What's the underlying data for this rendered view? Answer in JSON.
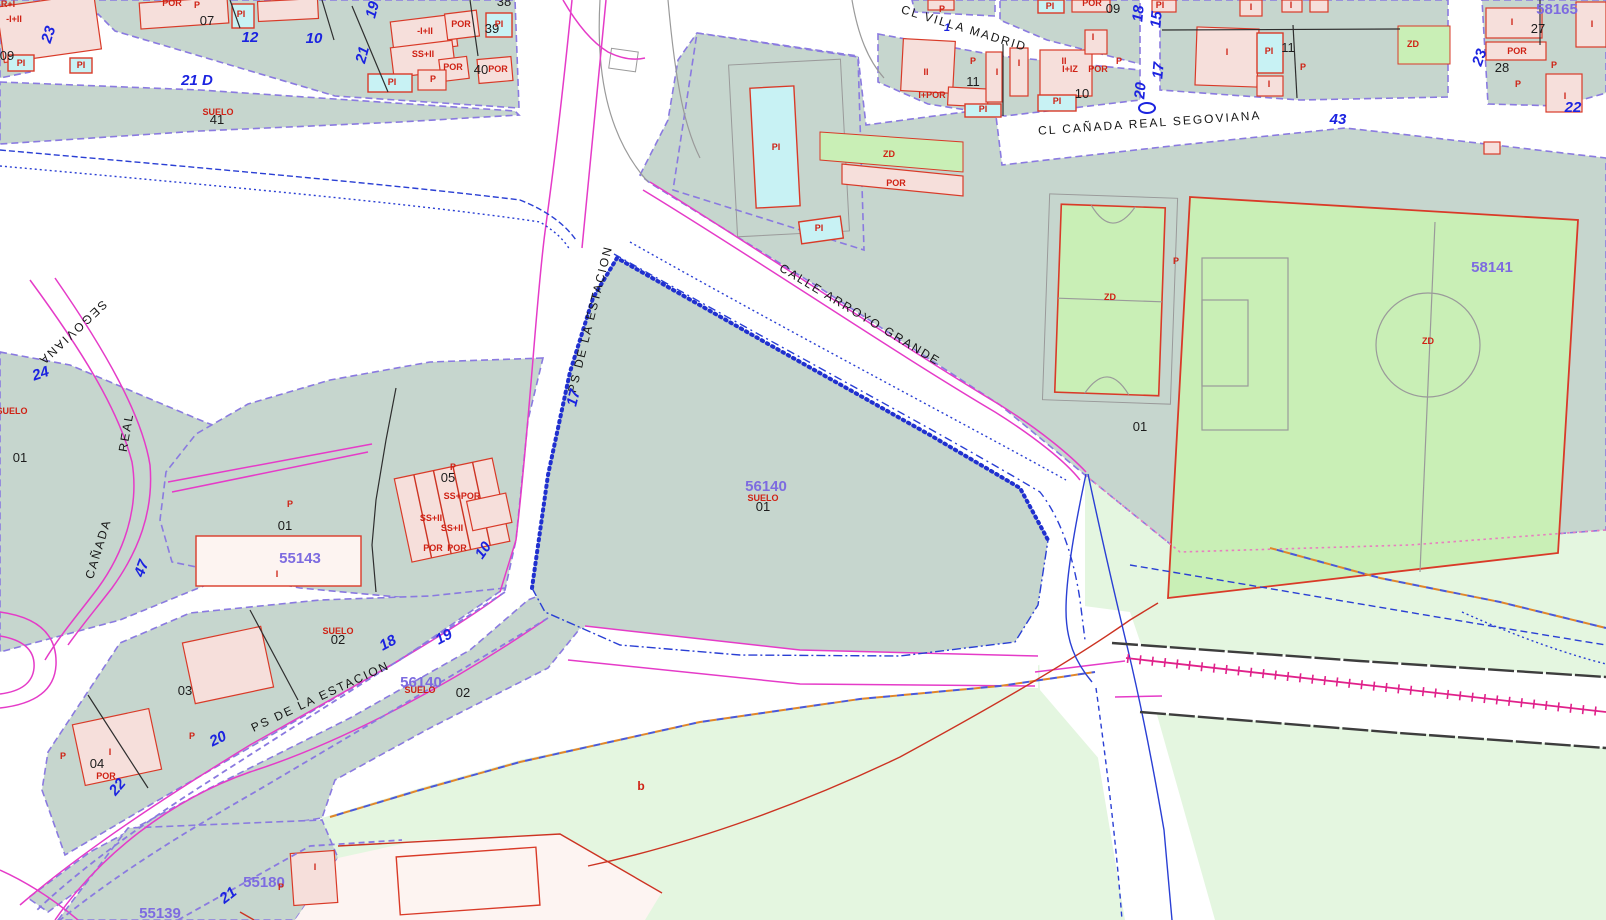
{
  "map": {
    "palette": {
      "urban_parcel": "#c6d6ce",
      "rustic_parcel": "#e4f6e0",
      "sports_green": "#c9efb6",
      "building": "#f6dfdb",
      "building_border": "#d93a28",
      "pool": "#c8f2f4",
      "parcel_border": "#8a7ae0",
      "street_line": "#e53bc8",
      "railway": "#e0218a",
      "stream": "#2a3fd4",
      "blue_number": "#1b23e0",
      "parcel_id": "#7d6be0",
      "use_label": "#cf2114"
    },
    "labels": [
      {
        "name": "street-cl-villa-madrid",
        "text": "CL VILLA MADRID",
        "x": 963,
        "y": 32,
        "rot": 17,
        "cls": "street"
      },
      {
        "name": "street-cl-canada-real-segoviana",
        "text": "CL  CAÑADA  REAL  SEGOVIANA",
        "x": 1150,
        "y": 127,
        "rot": -4,
        "cls": "street"
      },
      {
        "name": "street-calle-arroyo-grande",
        "text": "CALLE  ARROYO  GRANDE",
        "x": 858,
        "y": 318,
        "rot": 31,
        "cls": "street"
      },
      {
        "name": "street-ps-de-la-estacion-north",
        "text": "PS DE LA ESTACION",
        "x": 594,
        "y": 320,
        "rot": -76,
        "cls": "street"
      },
      {
        "name": "street-ps-de-la-estacion-south",
        "text": "PS  DE  LA  ESTACION",
        "x": 322,
        "y": 700,
        "rot": -25,
        "cls": "street"
      },
      {
        "name": "street-canada",
        "text": "CAÑADA",
        "x": 102,
        "y": 550,
        "rot": -73,
        "cls": "street"
      },
      {
        "name": "street-real",
        "text": "REAL",
        "x": 130,
        "y": 433,
        "rot": -80,
        "cls": "street"
      },
      {
        "name": "street-segoviana",
        "text": "SEGOVIANA",
        "x": 70,
        "y": 330,
        "rot": 137,
        "cls": "street"
      },
      {
        "name": "street-number",
        "text": "21 D",
        "x": 197,
        "y": 85,
        "rot": 0,
        "cls": "blue"
      },
      {
        "name": "street-number",
        "text": "12",
        "x": 250,
        "y": 42,
        "rot": 0,
        "cls": "blue"
      },
      {
        "name": "street-number",
        "text": "10",
        "x": 314,
        "y": 43,
        "rot": 0,
        "cls": "blue"
      },
      {
        "name": "street-number",
        "text": "23",
        "x": 53,
        "y": 36,
        "rot": -72,
        "cls": "blue"
      },
      {
        "name": "street-number",
        "text": "19",
        "x": 377,
        "y": 11,
        "rot": -75,
        "cls": "blue"
      },
      {
        "name": "street-number",
        "text": "21",
        "x": 367,
        "y": 56,
        "rot": -75,
        "cls": "blue"
      },
      {
        "name": "street-number",
        "text": "24",
        "x": 42,
        "y": 378,
        "rot": -18,
        "cls": "blue"
      },
      {
        "name": "street-number",
        "text": "47",
        "x": 146,
        "y": 570,
        "rot": -70,
        "cls": "blue"
      },
      {
        "name": "street-number",
        "text": "17",
        "x": 578,
        "y": 399,
        "rot": -76,
        "cls": "blue"
      },
      {
        "name": "street-number",
        "text": "10",
        "x": 487,
        "y": 553,
        "rot": -55,
        "cls": "blue"
      },
      {
        "name": "street-number",
        "text": "18",
        "x": 390,
        "y": 647,
        "rot": -28,
        "cls": "blue"
      },
      {
        "name": "street-number",
        "text": "19",
        "x": 446,
        "y": 641,
        "rot": -28,
        "cls": "blue"
      },
      {
        "name": "street-number",
        "text": "20",
        "x": 220,
        "y": 743,
        "rot": -26,
        "cls": "blue"
      },
      {
        "name": "street-number",
        "text": "22",
        "x": 121,
        "y": 790,
        "rot": -50,
        "cls": "blue"
      },
      {
        "name": "street-number",
        "text": "21",
        "x": 231,
        "y": 899,
        "rot": -38,
        "cls": "blue"
      },
      {
        "name": "street-number",
        "text": "1",
        "x": 947,
        "y": 31,
        "rot": 0,
        "cls": "blue sm"
      },
      {
        "name": "street-number",
        "text": "18",
        "x": 1143,
        "y": 14,
        "rot": -85,
        "cls": "blue"
      },
      {
        "name": "street-number",
        "text": "20",
        "x": 1145,
        "y": 91,
        "rot": -85,
        "cls": "blue"
      },
      {
        "name": "street-number",
        "text": "15",
        "x": 1161,
        "y": 20,
        "rot": -85,
        "cls": "blue"
      },
      {
        "name": "street-number",
        "text": "17",
        "x": 1163,
        "y": 71,
        "rot": -85,
        "cls": "blue"
      },
      {
        "name": "street-number",
        "text": "43",
        "x": 1338,
        "y": 124,
        "rot": 0,
        "cls": "blue"
      },
      {
        "name": "street-number",
        "text": "22",
        "x": 1573,
        "y": 112,
        "rot": 0,
        "cls": "blue"
      },
      {
        "name": "street-number",
        "text": "23",
        "x": 1484,
        "y": 59,
        "rot": -70,
        "cls": "blue"
      },
      {
        "name": "parcel-id",
        "text": "58165",
        "x": 1557,
        "y": 14,
        "rot": 0,
        "cls": "purple"
      },
      {
        "name": "parcel-id",
        "text": "58141",
        "x": 1492,
        "y": 272,
        "rot": 0,
        "cls": "purple"
      },
      {
        "name": "parcel-id",
        "text": "56140",
        "x": 766,
        "y": 491,
        "rot": 0,
        "cls": "purple"
      },
      {
        "name": "parcel-id",
        "text": "55143",
        "x": 300,
        "y": 563,
        "rot": 0,
        "cls": "purple"
      },
      {
        "name": "parcel-id",
        "text": "56140",
        "x": 421,
        "y": 687,
        "rot": 0,
        "cls": "purple"
      },
      {
        "name": "parcel-id",
        "text": "55180",
        "x": 264,
        "y": 887,
        "rot": 0,
        "cls": "purple"
      },
      {
        "name": "parcel-id",
        "text": "55139",
        "x": 160,
        "y": 918,
        "rot": 0,
        "cls": "purple"
      },
      {
        "name": "lot-number",
        "text": "07",
        "x": 207,
        "y": 25,
        "rot": 0,
        "cls": "black"
      },
      {
        "name": "lot-number",
        "text": "38",
        "x": 504,
        "y": 6,
        "rot": 0,
        "cls": "black"
      },
      {
        "name": "lot-number",
        "text": "39",
        "x": 492,
        "y": 33,
        "rot": 0,
        "cls": "black"
      },
      {
        "name": "lot-number",
        "text": "40",
        "x": 481,
        "y": 74,
        "rot": 0,
        "c ls": "black",
        "cls": "black"
      },
      {
        "name": "lot-number",
        "text": "09",
        "x": 7,
        "y": 60,
        "rot": 0,
        "cls": "black"
      },
      {
        "name": "lot-number",
        "text": "41",
        "x": 217,
        "y": 124,
        "rot": 0,
        "cls": "black"
      },
      {
        "name": "lot-number",
        "text": "09",
        "x": 1113,
        "y": 13,
        "rot": 0,
        "cls": "black"
      },
      {
        "name": "lot-number",
        "text": "11",
        "x": 973,
        "y": 86,
        "rot": 0,
        "cls": "black"
      },
      {
        "name": "lot-number",
        "text": "10",
        "x": 1082,
        "y": 98,
        "rot": 0,
        "cls": "black"
      },
      {
        "name": "lot-number",
        "text": "11",
        "x": 1288,
        "y": 52,
        "rot": 0,
        "cls": "black"
      },
      {
        "name": "lot-number",
        "text": "27",
        "x": 1538,
        "y": 33,
        "rot": 0,
        "cls": "black"
      },
      {
        "name": "lot-number",
        "text": "28",
        "x": 1502,
        "y": 72,
        "rot": 0,
        "cls": "black"
      },
      {
        "name": "lot-number",
        "text": "01",
        "x": 20,
        "y": 462,
        "rot": 0,
        "cls": "black"
      },
      {
        "name": "lot-number",
        "text": "01",
        "x": 285,
        "y": 530,
        "rot": 0,
        "cls": "black"
      },
      {
        "name": "lot-number",
        "text": "05",
        "x": 448,
        "y": 482,
        "rot": 0,
        "cls": "black"
      },
      {
        "name": "lot-number",
        "text": "02",
        "x": 338,
        "y": 644,
        "rot": 0,
        "cls": "black"
      },
      {
        "name": "lot-number",
        "text": "03",
        "x": 185,
        "y": 695,
        "rot": 0,
        "cls": "black"
      },
      {
        "name": "lot-number",
        "text": "04",
        "x": 97,
        "y": 768,
        "rot": 0,
        "cls": "black"
      },
      {
        "name": "lot-number",
        "text": "01",
        "x": 1140,
        "y": 431,
        "rot": 0,
        "cls": "black"
      },
      {
        "name": "lot-number",
        "text": "01",
        "x": 763,
        "y": 511,
        "rot": 0,
        "cls": "black"
      },
      {
        "name": "lot-number",
        "text": "02",
        "x": 463,
        "y": 697,
        "rot": 0,
        "cls": "black"
      },
      {
        "name": "suelo-label",
        "text": "SUELO",
        "x": 218,
        "y": 115,
        "rot": 0,
        "cls": "red"
      },
      {
        "name": "suelo-label",
        "text": "SUELO",
        "x": 12,
        "y": 414,
        "rot": 0,
        "cls": "red"
      },
      {
        "name": "suelo-label",
        "text": "SUELO",
        "x": 763,
        "y": 501,
        "rot": 0,
        "cls": "red"
      },
      {
        "name": "suelo-label",
        "text": "SUELO",
        "x": 338,
        "y": 634,
        "rot": 0,
        "cls": "red"
      },
      {
        "name": "suelo-label",
        "text": "SUELO",
        "x": 420,
        "y": 693,
        "rot": 0,
        "cls": "red"
      },
      {
        "name": "use-label",
        "text": "POR",
        "x": 172,
        "y": 6,
        "rot": 0,
        "cls": "red"
      },
      {
        "name": "use-label",
        "text": "P",
        "x": 197,
        "y": 8,
        "rot": 0,
        "cls": "red"
      },
      {
        "name": "use-label",
        "text": "PI",
        "x": 21,
        "y": 66,
        "rot": 0,
        "cls": "red"
      },
      {
        "name": "use-label",
        "text": "PI",
        "x": 81,
        "y": 68,
        "rot": 0,
        "cls": "red"
      },
      {
        "name": "use-label",
        "text": "R+I",
        "x": 8,
        "y": 7,
        "rot": 0,
        "cls": "red"
      },
      {
        "name": "use-label",
        "text": "-I+II",
        "x": 14,
        "y": 22,
        "rot": 0,
        "cls": "red"
      },
      {
        "name": "use-label",
        "text": "PI",
        "x": 241,
        "y": 17,
        "rot": 0,
        "cls": "red"
      },
      {
        "name": "use-label",
        "text": "-I+II",
        "x": 425,
        "y": 34,
        "rot": 0,
        "cls": "red"
      },
      {
        "name": "use-label",
        "text": "POR",
        "x": 461,
        "y": 27,
        "rot": 0,
        "cls": "red"
      },
      {
        "name": "use-label",
        "text": "PI",
        "x": 499,
        "y": 27,
        "rot": 0,
        "cls": "red"
      },
      {
        "name": "use-label",
        "text": "SS+II",
        "x": 423,
        "y": 57,
        "rot": 0,
        "cls": "red"
      },
      {
        "name": "use-label",
        "text": "POR",
        "x": 453,
        "y": 70,
        "rot": 0,
        "cls": "red"
      },
      {
        "name": "use-label",
        "text": "POR",
        "x": 498,
        "y": 72,
        "rot": 0,
        "cls": "red"
      },
      {
        "name": "use-label",
        "text": "PI",
        "x": 392,
        "y": 85,
        "rot": 0,
        "cls": "red"
      },
      {
        "name": "use-label",
        "text": "P",
        "x": 433,
        "y": 82,
        "rot": 0,
        "cls": "red"
      },
      {
        "name": "use-label",
        "text": "P",
        "x": 942,
        "y": 12,
        "rot": 0,
        "cls": "red"
      },
      {
        "name": "use-label",
        "text": "PI",
        "x": 1050,
        "y": 9,
        "rot": 0,
        "cls": "red"
      },
      {
        "name": "use-label",
        "text": "POR",
        "x": 1092,
        "y": 6,
        "rot": 0,
        "cls": "red"
      },
      {
        "name": "use-label",
        "text": "II",
        "x": 926,
        "y": 75,
        "rot": 0,
        "cls": "red"
      },
      {
        "name": "use-label",
        "text": "P",
        "x": 973,
        "y": 64,
        "rot": 0,
        "cls": "red"
      },
      {
        "name": "use-label",
        "text": "I",
        "x": 997,
        "y": 75,
        "rot": 0,
        "cls": "red"
      },
      {
        "name": "use-label",
        "text": "I",
        "x": 1019,
        "y": 66,
        "rot": 0,
        "cls": "red"
      },
      {
        "name": "use-label",
        "text": "II",
        "x": 1064,
        "y": 64,
        "rot": 0,
        "cls": "red"
      },
      {
        "name": "use-label",
        "text": "I",
        "x": 1093,
        "y": 40,
        "rot": 0,
        "cls": "red"
      },
      {
        "name": "use-label",
        "text": "I+IZ",
        "x": 1070,
        "y": 72,
        "rot": 0,
        "cls": "red"
      },
      {
        "name": "use-label",
        "text": "POR",
        "x": 1098,
        "y": 72,
        "rot": 0,
        "cls": "red"
      },
      {
        "name": "use-label",
        "text": "P",
        "x": 1119,
        "y": 64,
        "rot": 0,
        "cls": "red"
      },
      {
        "name": "use-label",
        "text": "I+POR",
        "x": 932,
        "y": 98,
        "rot": 0,
        "cls": "red"
      },
      {
        "name": "use-label",
        "text": "PI",
        "x": 1057,
        "y": 104,
        "rot": 0,
        "cls": "red"
      },
      {
        "name": "use-label",
        "text": "PI",
        "x": 983,
        "y": 112,
        "rot": 0,
        "cls": "red"
      },
      {
        "name": "use-label",
        "text": "PI",
        "x": 1160,
        "y": 8,
        "rot": 0,
        "cls": "red"
      },
      {
        "name": "use-label",
        "text": "I",
        "x": 1227,
        "y": 55,
        "rot": 0,
        "cls": "red"
      },
      {
        "name": "use-label",
        "text": "PI",
        "x": 1269,
        "y": 54,
        "rot": 0,
        "cls": "red"
      },
      {
        "name": "use-label",
        "text": "I",
        "x": 1269,
        "y": 87,
        "rot": 0,
        "cls": "red"
      },
      {
        "name": "use-label",
        "text": "P",
        "x": 1303,
        "y": 70,
        "rot": 0,
        "cls": "red"
      },
      {
        "name": "use-label",
        "text": "I",
        "x": 1251,
        "y": 10,
        "rot": 0,
        "cls": "red"
      },
      {
        "name": "use-label",
        "text": "I",
        "x": 1291,
        "y": 8,
        "rot": 0,
        "cls": "red"
      },
      {
        "name": "use-label",
        "text": "ZD",
        "x": 1413,
        "y": 47,
        "rot": 0,
        "cls": "red"
      },
      {
        "name": "use-label",
        "text": "POR",
        "x": 1517,
        "y": 54,
        "rot": 0,
        "cls": "red"
      },
      {
        "name": "use-label",
        "text": "P",
        "x": 1554,
        "y": 68,
        "rot": 0,
        "cls": "red"
      },
      {
        "name": "use-label",
        "text": "P",
        "x": 1518,
        "y": 87,
        "rot": 0,
        "cls": "red"
      },
      {
        "name": "use-label",
        "text": "I",
        "x": 1565,
        "y": 99,
        "rot": 0,
        "cls": "red"
      },
      {
        "name": "use-label",
        "text": "I",
        "x": 1512,
        "y": 25,
        "rot": 0,
        "cls": "red"
      },
      {
        "name": "use-label",
        "text": "I",
        "x": 1592,
        "y": 27,
        "rot": 0,
        "cls": "red"
      },
      {
        "name": "use-label",
        "text": "PI",
        "x": 776,
        "y": 150,
        "rot": 0,
        "cls": "red"
      },
      {
        "name": "use-label",
        "text": "PI",
        "x": 819,
        "y": 231,
        "rot": 0,
        "cls": "red"
      },
      {
        "name": "use-label",
        "text": "ZD",
        "x": 889,
        "y": 157,
        "rot": 0,
        "cls": "red"
      },
      {
        "name": "use-label",
        "text": "POR",
        "x": 896,
        "y": 186,
        "rot": 0,
        "cls": "red"
      },
      {
        "name": "use-label",
        "text": "ZD",
        "x": 1110,
        "y": 300,
        "rot": 0,
        "cls": "red"
      },
      {
        "name": "use-label",
        "text": "P",
        "x": 1176,
        "y": 264,
        "rot": 0,
        "cls": "red"
      },
      {
        "name": "use-label",
        "text": "ZD",
        "x": 1428,
        "y": 344,
        "rot": 0,
        "cls": "red"
      },
      {
        "name": "use-label",
        "text": "P",
        "x": 453,
        "y": 470,
        "rot": 0,
        "cls": "red"
      },
      {
        "name": "use-label",
        "text": "SS+POR",
        "x": 462,
        "y": 499,
        "rot": 0,
        "cls": "red"
      },
      {
        "name": "use-label",
        "text": "SS+II",
        "x": 431,
        "y": 521,
        "rot": 0,
        "cls": "red"
      },
      {
        "name": "use-label",
        "text": "SS+II",
        "x": 452,
        "y": 531,
        "rot": 0,
        "cls": "red"
      },
      {
        "name": "use-label",
        "text": "POR",
        "x": 433,
        "y": 551,
        "rot": 0,
        "cls": "red"
      },
      {
        "name": "use-label",
        "text": "POR",
        "x": 457,
        "y": 551,
        "rot": 0,
        "cls": "red"
      },
      {
        "name": "use-label",
        "text": "P",
        "x": 290,
        "y": 507,
        "rot": 0,
        "cls": "red"
      },
      {
        "name": "use-label",
        "text": "I",
        "x": 277,
        "y": 577,
        "rot": 0,
        "cls": "red"
      },
      {
        "name": "use-label",
        "text": "P",
        "x": 192,
        "y": 739,
        "rot": 0,
        "cls": "red"
      },
      {
        "name": "use-label",
        "text": "P",
        "x": 63,
        "y": 759,
        "rot": 0,
        "cls": "red"
      },
      {
        "name": "use-label",
        "text": "POR",
        "x": 106,
        "y": 779,
        "rot": 0,
        "cls": "red"
      },
      {
        "name": "use-label",
        "text": "I",
        "x": 110,
        "y": 755,
        "rot": 0,
        "cls": "red"
      },
      {
        "name": "use-label",
        "text": "I",
        "x": 315,
        "y": 870,
        "rot": 0,
        "cls": "red"
      },
      {
        "name": "use-label",
        "text": "P",
        "x": 281,
        "y": 890,
        "rot": 0,
        "cls": "red"
      },
      {
        "name": "subparcel-label",
        "text": "b",
        "x": 641,
        "y": 790,
        "rot": 0,
        "cls": "redb"
      }
    ]
  }
}
